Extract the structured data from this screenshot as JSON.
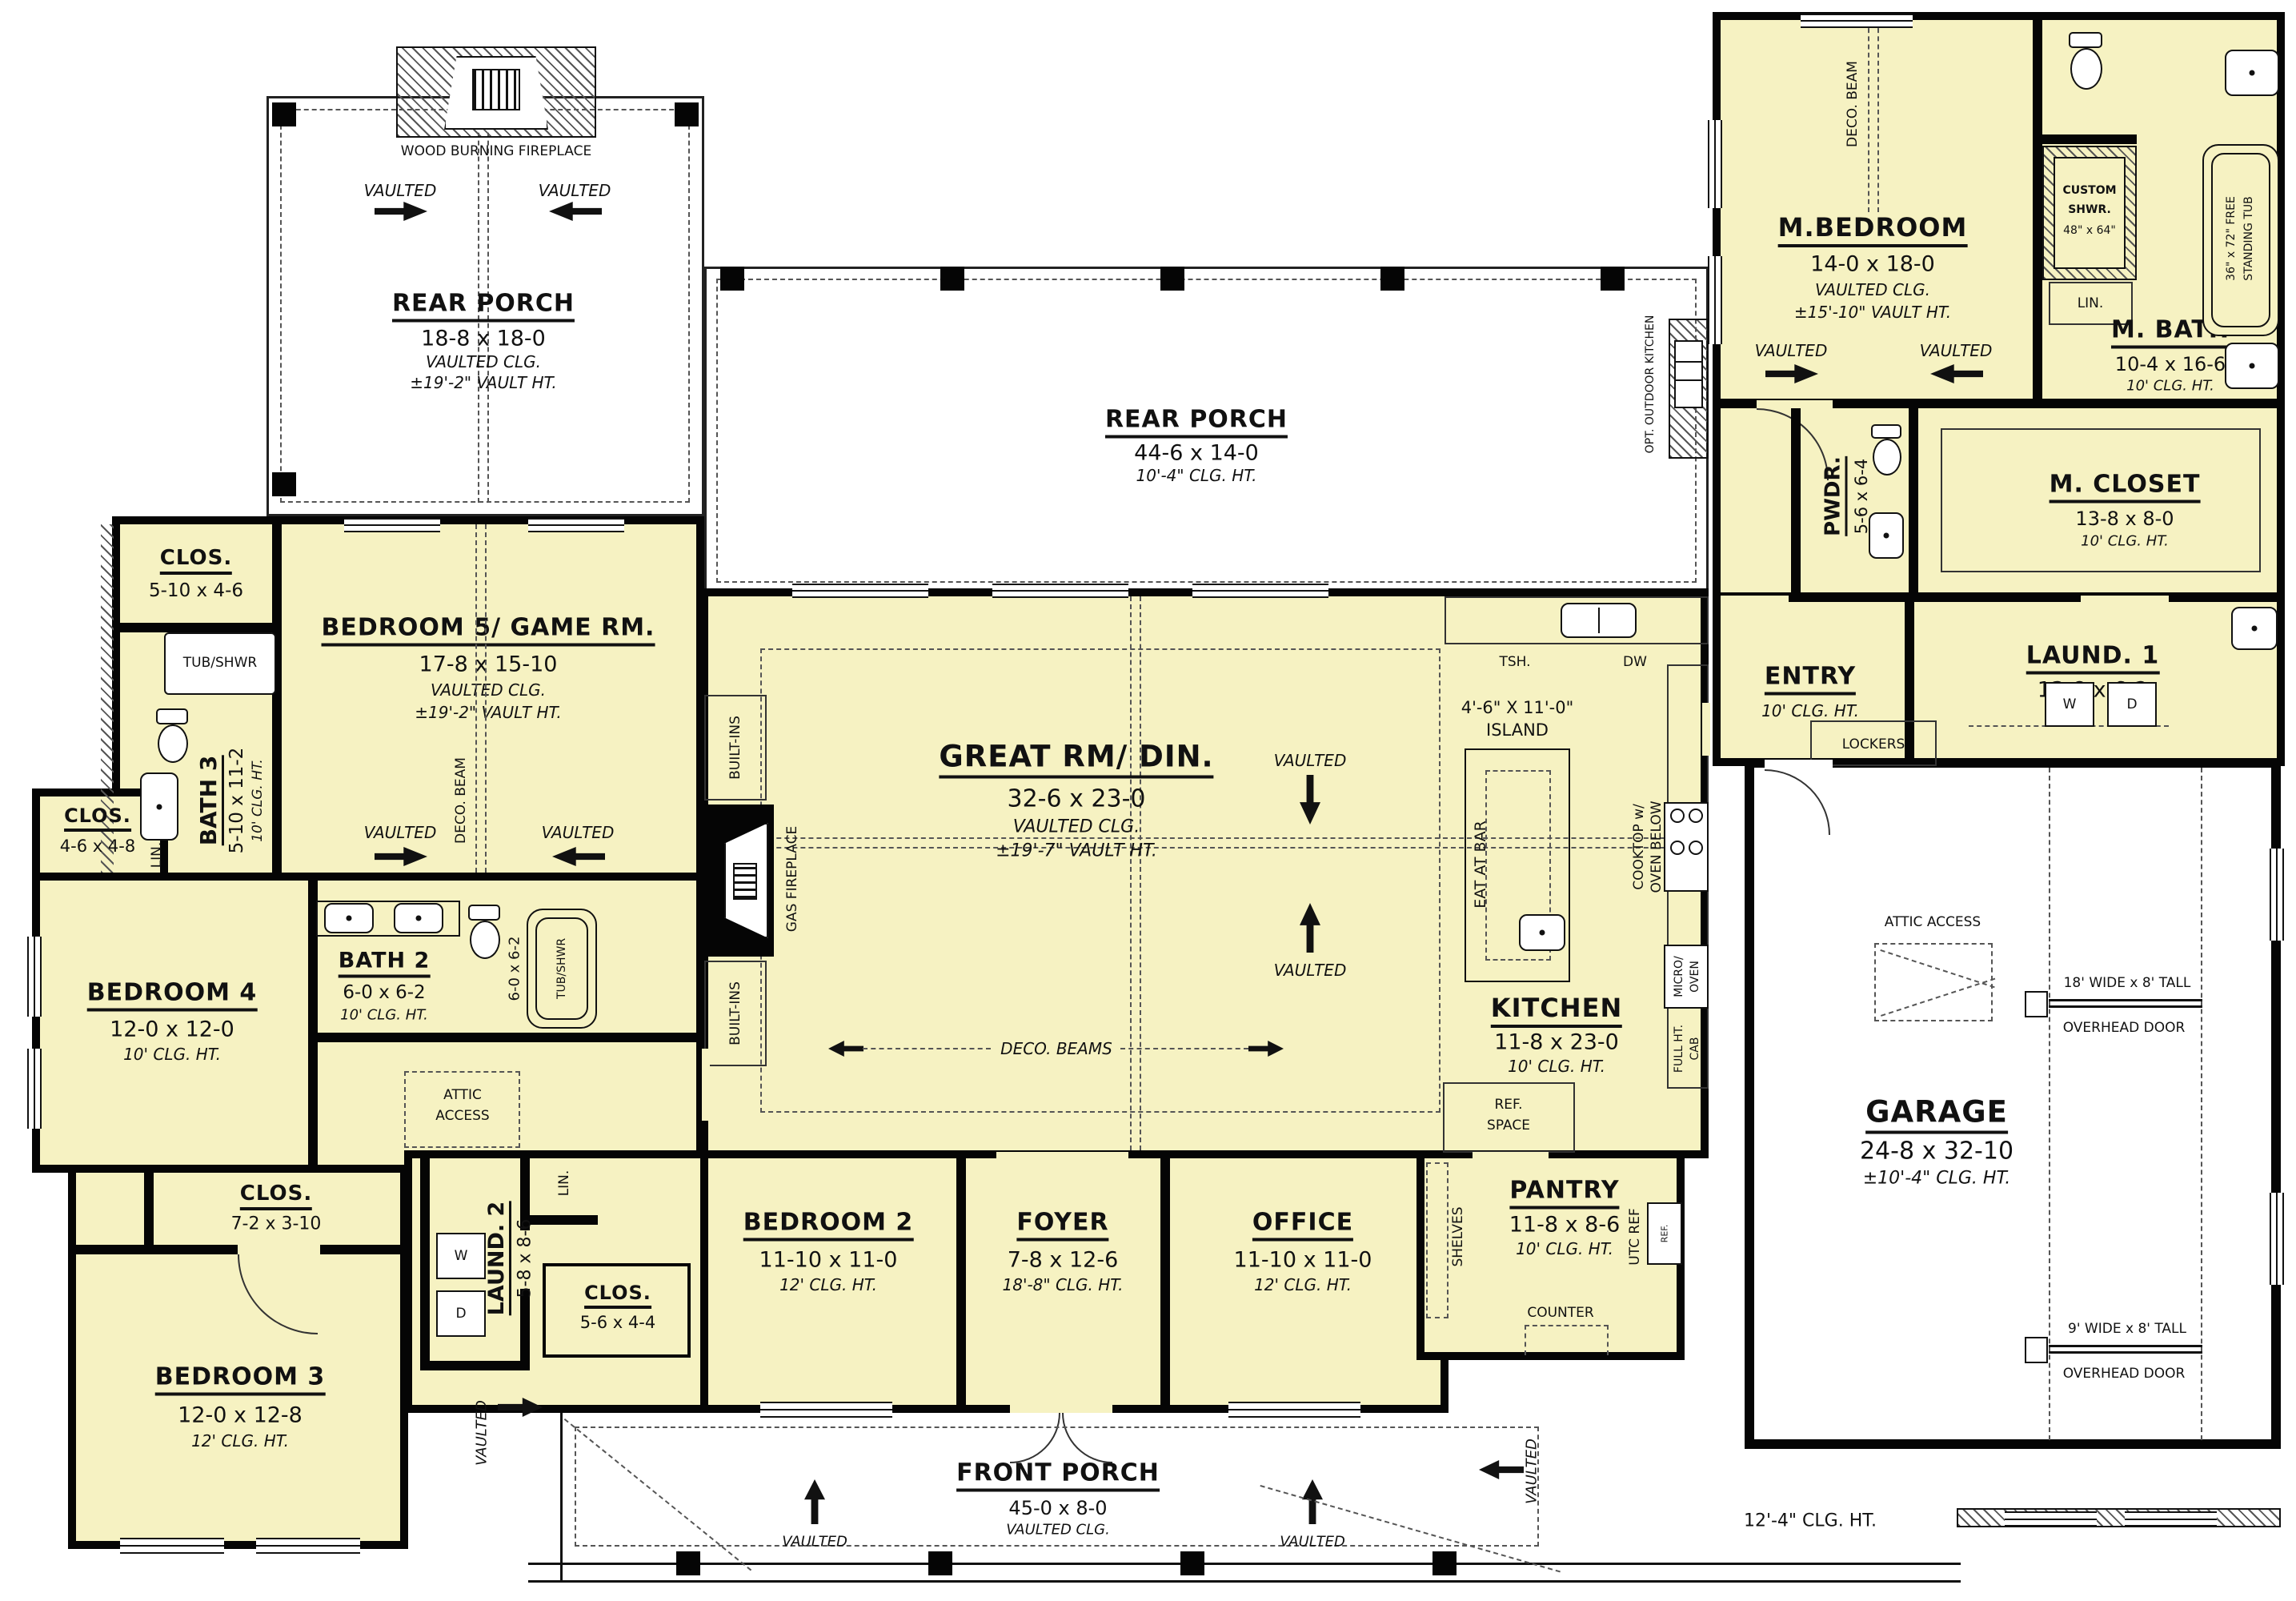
{
  "colors": {
    "room_fill": "#f6f2c2",
    "wall": "#050505",
    "dash": "#555555",
    "paper": "#ffffff"
  },
  "labels": {
    "vaulted": "VAULTED",
    "wood_fireplace": "WOOD BURNING FIREPLACE",
    "deco_beam": "DECO. BEAM",
    "deco_beams": "DECO. BEAMS",
    "built_ins": "BUILT-INS",
    "gas_fireplace": "GAS FIREPLACE",
    "attic_access": "ATTIC ACCESS",
    "attic_1": "ATTIC",
    "attic_2": "ACCESS",
    "lockers": "LOCKERS",
    "counter": "COUNTER",
    "shelves": "SHELVES",
    "eat_at_bar": "EAT AT BAR",
    "tsh": "TSH.",
    "dw": "DW",
    "lin": "LIN.",
    "w": "W",
    "d": "D",
    "ref_1": "REF.",
    "ref_2": "SPACE",
    "utc_ref": "UTC REF",
    "ref": "REF.",
    "cooktop_1": "COOKTOP w/",
    "cooktop_2": "OVEN BELOW",
    "micro_1": "MICRO/",
    "micro_2": "OVEN",
    "fullht_1": "FULL HT.",
    "fullht_2": "CAB",
    "tub_shwr": "TUB/SHWR",
    "tub2_dim": "6-0 x 6-2",
    "free_tub_1": "36\" x 72\" FREE",
    "free_tub_2": "STANDING TUB",
    "island_1": "4'-6\" X 11'-0\"",
    "island_2": "ISLAND",
    "ohd_18": "18' WIDE x 8' TALL",
    "ohd_9": "9' WIDE x 8' TALL",
    "ohd": "OVERHEAD DOOR",
    "clg_12_4": "12'-4\" CLG. HT.",
    "opt_outdoor": "OPT. OUTDOOR KITCHEN"
  },
  "rooms": {
    "rear_porch_left": {
      "name": "REAR PORCH",
      "dims": "18-8 x 18-0",
      "l1": "VAULTED CLG.",
      "l2": "±19'-2\" VAULT HT."
    },
    "rear_porch_main": {
      "name": "REAR PORCH",
      "dims": "44-6 x 14-0",
      "l1": "10'-4\" CLG. HT."
    },
    "m_bedroom": {
      "name": "M.BEDROOM",
      "dims": "14-0 x 18-0",
      "l1": "VAULTED CLG.",
      "l2": "±15'-10\" VAULT HT."
    },
    "custom_shwr": {
      "name1": "CUSTOM",
      "name2": "SHWR.",
      "dims": "48\" x 64\""
    },
    "m_bath": {
      "name": "M. BATH",
      "dims": "10-4 x 16-6",
      "l1": "10' CLG. HT."
    },
    "m_closet": {
      "name": "M. CLOSET",
      "dims": "13-8 x 8-0",
      "l1": "10' CLG. HT."
    },
    "pwdr": {
      "name": "PWDR.",
      "dims": "5-6 x 6-4"
    },
    "entry": {
      "name": "ENTRY",
      "l1": "10' CLG. HT."
    },
    "laund1": {
      "name": "LAUND. 1",
      "dims": "13-8 x 6-2"
    },
    "garage": {
      "name": "GARAGE",
      "dims": "24-8 x 32-10",
      "l1": "±10'-4\" CLG. HT."
    },
    "great": {
      "name": "GREAT RM/ DIN.",
      "dims": "32-6 x 23-0",
      "l1": "VAULTED CLG.",
      "l2": "±19'-7\" VAULT HT."
    },
    "kitchen": {
      "name": "KITCHEN",
      "dims": "11-8 x 23-0",
      "l1": "10' CLG. HT."
    },
    "island": {
      "name": "ISLAND",
      "dims": "4'-6\" X 11'-0\""
    },
    "pantry": {
      "name": "PANTRY",
      "dims": "11-8 x 8-6",
      "l1": "10' CLG. HT."
    },
    "bed5": {
      "name": "BEDROOM 5/ GAME RM.",
      "dims": "17-8 x 15-10",
      "l1": "VAULTED CLG.",
      "l2": "±19'-2\" VAULT HT."
    },
    "clos_b5": {
      "name": "CLOS.",
      "dims": "5-10 x 4-6"
    },
    "bath3": {
      "name": "BATH 3",
      "dims": "5-10 x 11-2",
      "l1": "10' CLG. HT."
    },
    "clos_b4": {
      "name": "CLOS.",
      "dims": "4-6 x 4-8"
    },
    "bed4": {
      "name": "BEDROOM 4",
      "dims": "12-0 x 12-0",
      "l1": "10' CLG. HT."
    },
    "bath2": {
      "name": "BATH 2",
      "dims": "6-0 x 6-2",
      "l1": "10' CLG. HT."
    },
    "bed3": {
      "name": "BEDROOM 3",
      "dims": "12-0 x 12-8",
      "l1": "12' CLG. HT."
    },
    "clos_b3": {
      "name": "CLOS.",
      "dims": "7-2 x 3-10"
    },
    "laund2": {
      "name": "LAUND. 2",
      "dims": "5-8 x 8-6"
    },
    "clos_hall": {
      "name": "CLOS.",
      "dims": "5-6 x 4-4"
    },
    "bed2": {
      "name": "BEDROOM 2",
      "dims": "11-10 x 11-0",
      "l1": "12' CLG. HT."
    },
    "foyer": {
      "name": "FOYER",
      "dims": "7-8 x 12-6",
      "l1": "18'-8\" CLG. HT."
    },
    "office": {
      "name": "OFFICE",
      "dims": "11-10 x 11-0",
      "l1": "12' CLG. HT."
    },
    "front_porch": {
      "name": "FRONT PORCH",
      "dims": "45-0 x 8-0",
      "l1": "VAULTED CLG."
    }
  }
}
